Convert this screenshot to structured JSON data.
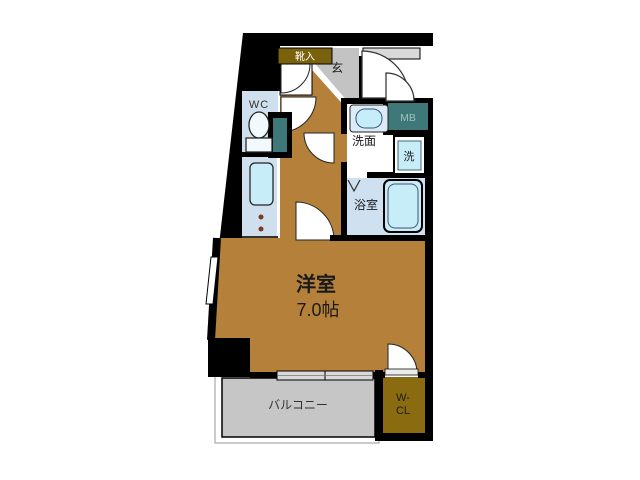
{
  "plan": {
    "type": "apartment-floor-plan",
    "labels": {
      "main_room_name": "洋室",
      "main_room_size": "7.0帖",
      "balcony": "バルコニー",
      "toilet": "WC",
      "washroom": "洗面",
      "bathroom": "浴室",
      "washer": "洗",
      "meter_box": "MB",
      "entrance": "玄",
      "shoe_cabinet": "靴入",
      "closet_line1": "W-",
      "closet_line2": "CL"
    },
    "colors": {
      "room_floor": "#b5813a",
      "closet": "#8b6b10",
      "shoe_cabinet": "#7a620c",
      "entrance_floor": "#c3c3c3",
      "balcony_floor": "#c6c6c6",
      "utility_teal": "#3f7878",
      "wet_floor": "#cfdfee",
      "bath_floor": "#cfe0f1",
      "fixture_cyan": "#c6edf8",
      "sill_gray": "#d9d9d9",
      "wall": "#000000",
      "text_dark": "#1a1a1a",
      "mb_text": "#9fc0c0"
    }
  }
}
